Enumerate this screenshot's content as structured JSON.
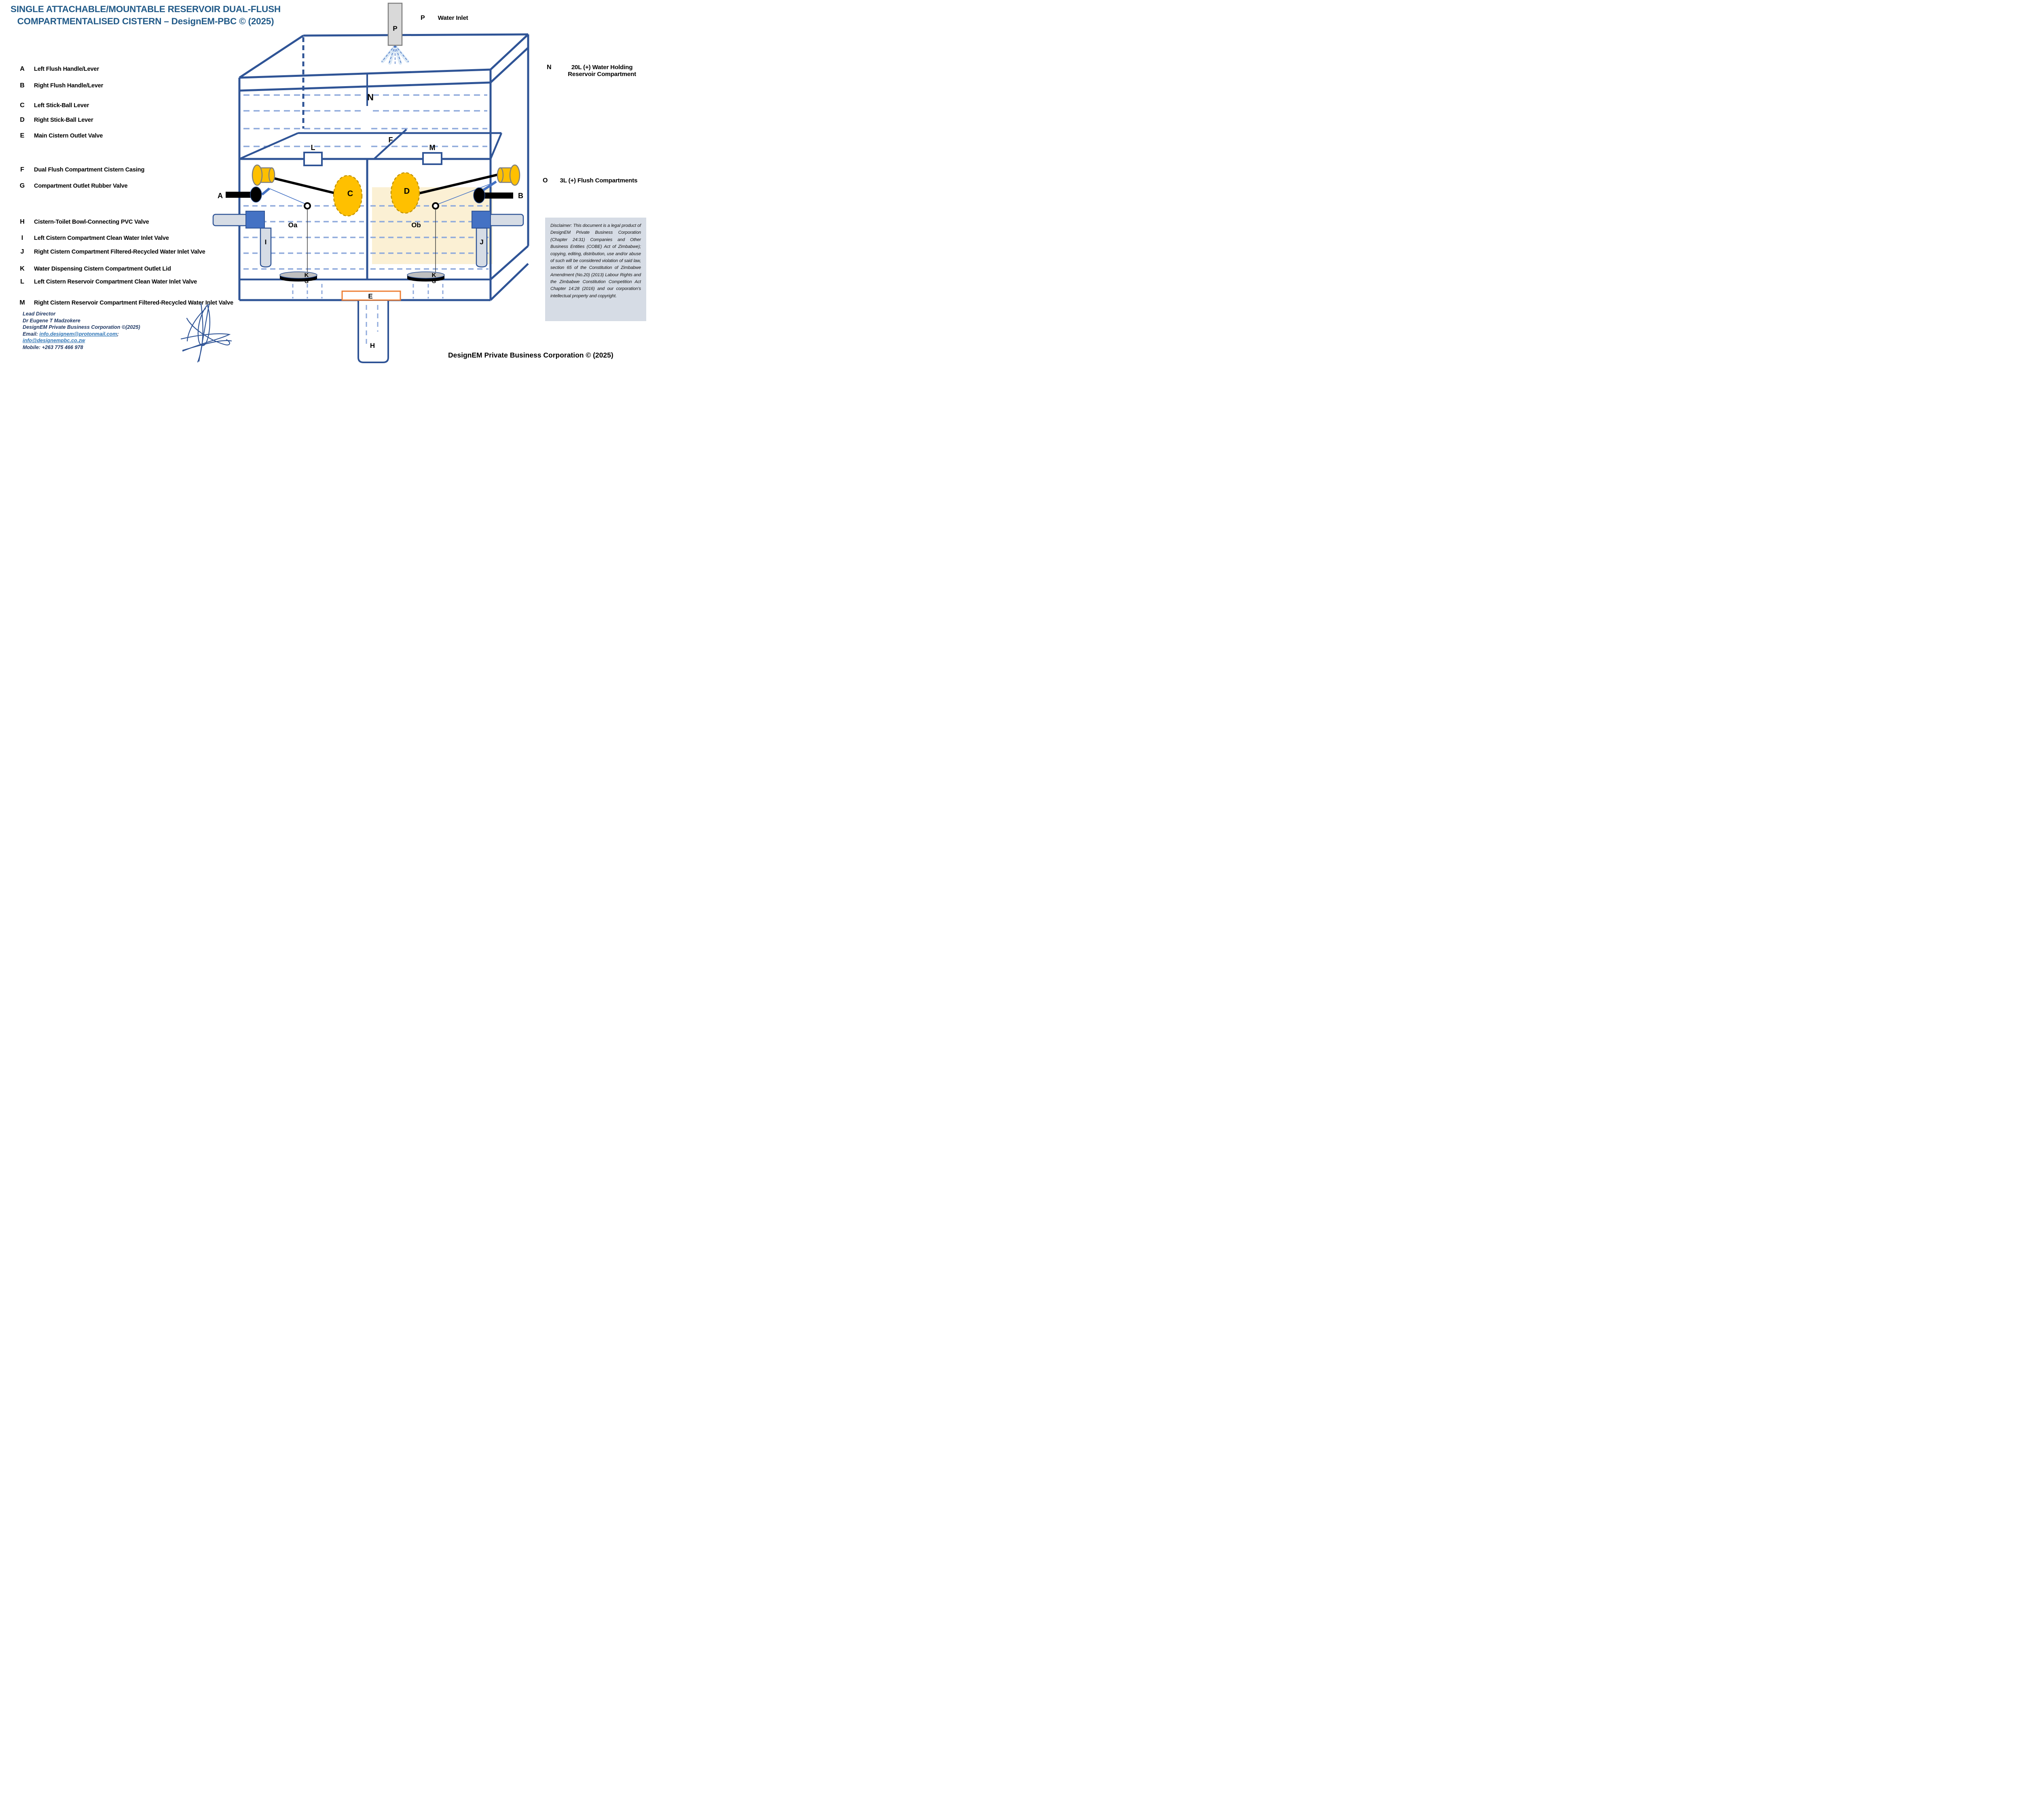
{
  "title": "SINGLE ATTACHABLE/MOUNTABLE RESERVOIR DUAL-FLUSH COMPARTMENTALISED CISTERN – DesignEM-PBC © (2025)",
  "legend": {
    "items": [
      {
        "key": "A",
        "label": "Left Flush Handle/Lever"
      },
      {
        "key": "B",
        "label": "Right Flush Handle/Lever"
      },
      {
        "key": "C",
        "label": "Left Stick-Ball Lever"
      },
      {
        "key": "D",
        "label": "Right Stick-Ball Lever"
      },
      {
        "key": "E",
        "label": "Main Cistern Outlet Valve"
      },
      {
        "key": "F",
        "label": "Dual Flush Compartment Cistern Casing"
      },
      {
        "key": "G",
        "label": "Compartment Outlet Rubber Valve"
      },
      {
        "key": "H",
        "label": "Cistern-Toilet Bowl-Connecting PVC Valve"
      },
      {
        "key": "I",
        "label": "Left Cistern Compartment Clean Water Inlet Valve"
      },
      {
        "key": "J",
        "label": "Right Cistern Compartment Filtered-Recycled Water Inlet Valve"
      },
      {
        "key": "K",
        "label": "Water Dispensing Cistern Compartment Outlet Lid"
      },
      {
        "key": "L",
        "label": "Left Cistern Reservoir Compartment Clean Water Inlet Valve"
      },
      {
        "key": "M",
        "label": "Right Cistern Reservoir Compartment Filtered-Recycled Water Inlet Valve"
      }
    ]
  },
  "annotations": {
    "P_key": "P",
    "P_text": "Water Inlet",
    "N_key": "N",
    "N_text": "20L (+) Water Holding Reservoir Compartment",
    "O_key": "O",
    "O_text": "3L (+) Flush Compartments"
  },
  "diagram": {
    "A": "A",
    "B": "B",
    "C": "C",
    "D": "D",
    "E": "E",
    "F": "F",
    "G": "G",
    "H": "H",
    "I": "I",
    "J": "J",
    "K": "K",
    "L": "L",
    "M": "M",
    "N": "N",
    "Oa": "Oa",
    "Ob": "Ob",
    "P": "P"
  },
  "contact": {
    "role": "Lead Director",
    "name": "Dr Eugene T Madzokere",
    "company": "DesignEM Private Business Corporation ©(2025)",
    "email_label": "Email: ",
    "email1": "info.designem@protonmail.com",
    "email1_suffix": ";",
    "email2": "info@designempbc.co.zw",
    "mobile": "Mobile: +263 775 466 978"
  },
  "disclaimer": "Disclaimer: This document is a legal product of DesignEM Private Business Corporation (Chapter 24:31) Companies and Other Business Entities (COBE) Act of Zimbabwe); copying, editing, distribution, use and/or abuse of such will be considered violation of said law, section 65 of the Constitution of Zimbabwe Amendment (No.20) (2013) Labour Rights and the Zimbabwe Constitution Competition Act Chapter 14:28 (2016) and our corporation’s intellectual property and copyright.",
  "footer_copyright": "DesignEM Private Business Corporation © (2025)",
  "colors": {
    "line_blue": "#2F5496",
    "water_blue": "#8FAADC",
    "float_yellow": "#FFC000",
    "float_border": "#C09200",
    "cream_fill": "#FBF0D4",
    "pipe_gray": "#D6DCE5",
    "fitting_blue": "#4472C4",
    "inlet_gray": "#D9D9D9",
    "disclaimer_bg": "#D6DCE5",
    "outlet_orange": "#ED7D31",
    "title_blue": "#215A88",
    "contact_navy": "#1F3864",
    "link_blue": "#2E75B6"
  }
}
